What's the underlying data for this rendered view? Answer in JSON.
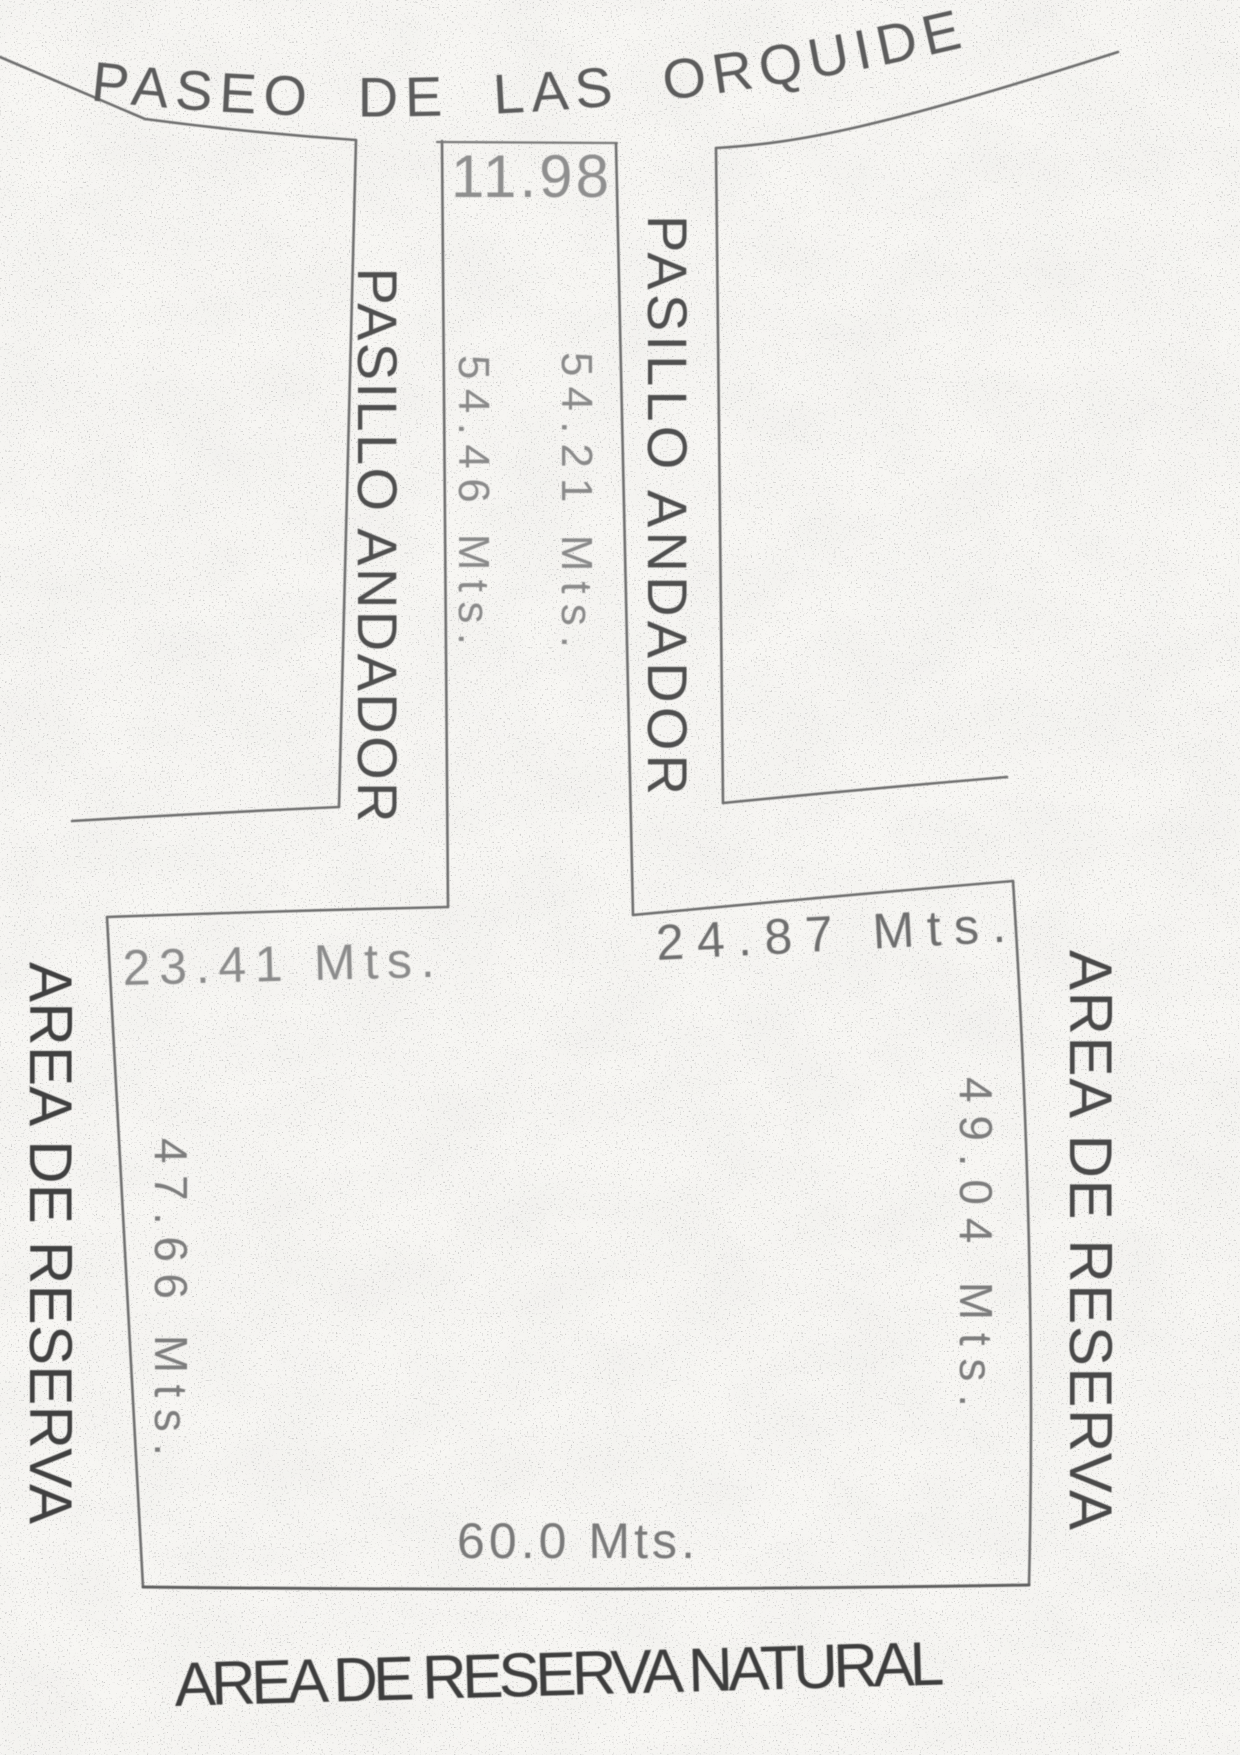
{
  "street": {
    "name": "PASEO DE LAS ORQUIDEAS"
  },
  "corridor": {
    "label_left": "PASILLO ANDADOR",
    "label_right": "PASILLO ANDADOR",
    "width_top": "11.98",
    "length_left_side": "54.46 Mts.",
    "length_right_side": "54.21 Mts."
  },
  "parcel": {
    "north_boundary_left": "23.41 Mts.",
    "north_boundary_right": "24.87 Mts.",
    "west_boundary": "47.66 Mts.",
    "east_boundary": "49.04 Mts.",
    "south_boundary": "60.0 Mts."
  },
  "surroundings": {
    "west_label": "AREA DE RESERVA",
    "east_label": "AREA DE RESERVA",
    "south_label": "AREA DE RESERVA NATURAL"
  },
  "colors": {
    "paper": "#f7f6f3",
    "ink_line": "#6f6f6f",
    "ink_text_dark": "#3c3c3c",
    "ink_text_mid": "#5c5c5c",
    "ink_text_light": "#8f8f8f"
  }
}
